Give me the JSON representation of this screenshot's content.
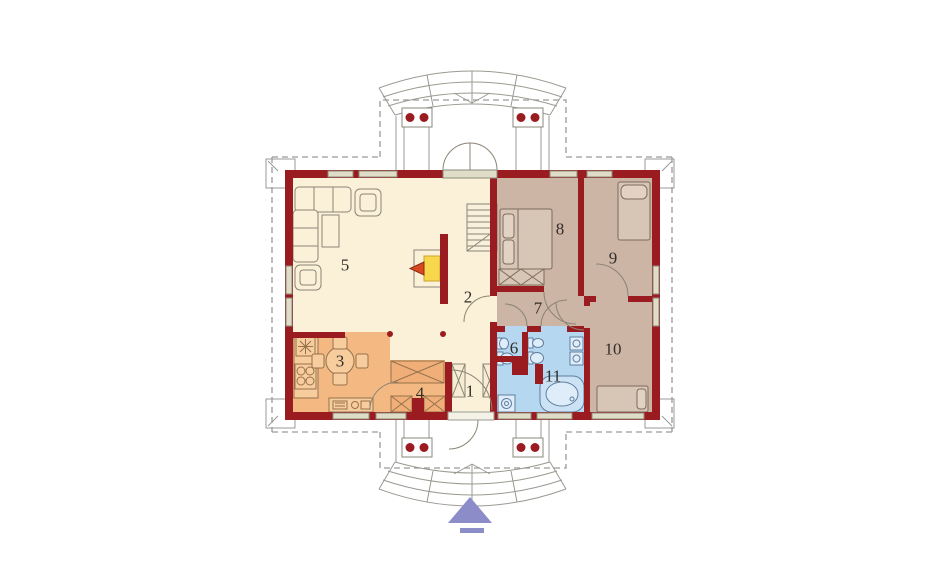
{
  "plan": {
    "type": "floor-plan",
    "rooms": [
      {
        "number": "1",
        "zone": "cream",
        "floor_color": "#FAF1D8"
      },
      {
        "number": "2",
        "zone": "cream",
        "floor_color": "#FAF1D8"
      },
      {
        "number": "3",
        "zone": "orange",
        "floor_color": "#F4B982"
      },
      {
        "number": "4",
        "zone": "orange",
        "floor_color": "#F4B982"
      },
      {
        "number": "5",
        "zone": "cream",
        "floor_color": "#FAF1D8"
      },
      {
        "number": "6",
        "zone": "blue",
        "floor_color": "#B5D8F0"
      },
      {
        "number": "7",
        "zone": "taupe",
        "floor_color": "#CCB5A5"
      },
      {
        "number": "8",
        "zone": "taupe",
        "floor_color": "#CCB5A5"
      },
      {
        "number": "9",
        "zone": "taupe",
        "floor_color": "#CCB5A5"
      },
      {
        "number": "10",
        "zone": "taupe",
        "floor_color": "#CCB5A5"
      },
      {
        "number": "11",
        "zone": "blue",
        "floor_color": "#B5D8F0"
      }
    ],
    "colors": {
      "wall": "#9B1C20",
      "floor_cream": "#FAF1D8",
      "floor_orange": "#F4B982",
      "floor_taupe": "#CCB5A5",
      "floor_blue": "#B5D8F0",
      "window_glass": "#DFDCC8",
      "furniture_outline": "#8C8476",
      "roof_dash": "#9A9A9A",
      "fireplace_yellow": "#F7D84C",
      "fireplace_flame": "#D8491F",
      "entrance_arrow": "#8B8CC8"
    },
    "entrance_arrow": {
      "glyph": "▲",
      "direction": "up"
    }
  }
}
